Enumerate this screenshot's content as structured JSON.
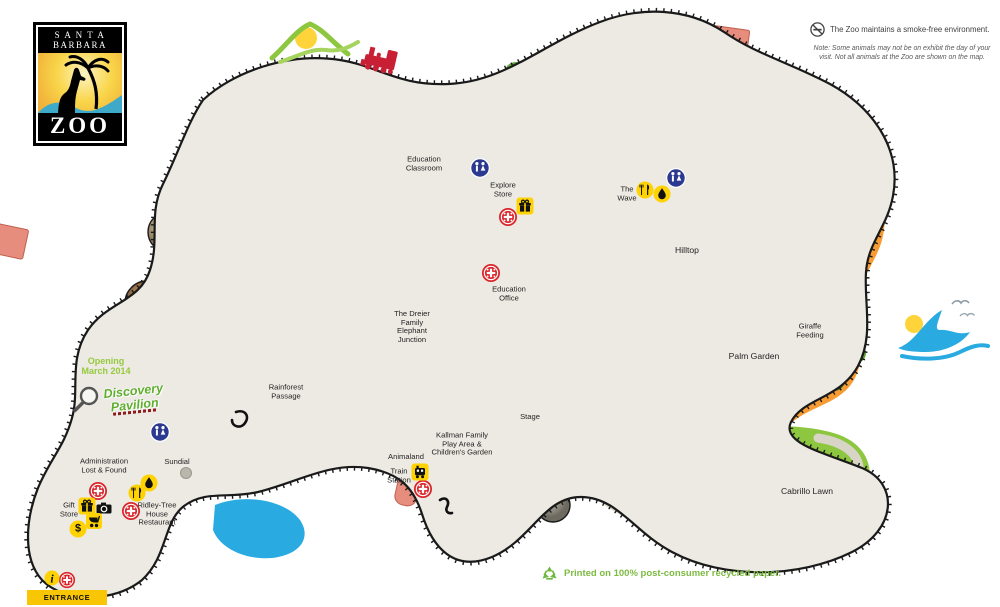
{
  "logo": {
    "city": "S A N T A\nBARBARA",
    "zoo": "ZOO"
  },
  "header_note": {
    "smoke_free": "The Zoo maintains a smoke-free environment.",
    "disclaimer": "Note: Some animals may not be on exhibit the day of your\nvisit.  Not all animals at the Zoo are shown on the map."
  },
  "footer": {
    "recycled": "Printed on 100% post-consumer recycled paper."
  },
  "locations": {
    "education_classroom": "Education\nClassroom",
    "explore_store": "Explore\nStore",
    "the_wave": "The\nWave",
    "hilltop": "Hilltop",
    "education_office": "Education\nOffice",
    "elephant_junction": "The Dreier\nFamily\nElephant\nJunction",
    "rainforest_passage": "Rainforest\nPassage",
    "giraffe_feeding": "Giraffe\nFeeding",
    "palm_garden": "Palm Garden",
    "stage": "Stage",
    "kallman": "Kallman Family\nPlay Area &\nChildren's Garden",
    "animaland": "Animaland",
    "train_station": "Train\nStation",
    "cabrillo_lawn": "Cabrillo Lawn",
    "administration": "Administration\nLost & Found",
    "sundial": "Sundial",
    "gift_store": "Gift\nStore",
    "ridley_tree": "Ridley-Tree\nHouse\nRestaurant",
    "entrance": "ENTRANCE",
    "opening": "Opening\nMarch 2014",
    "discovery_pavilion": "Discovery\nPavilion",
    "dollar_symbol": "$",
    "info_symbol": "i"
  },
  "icons": {
    "no_smoking": "no-smoking-icon",
    "restroom": "restroom-icon",
    "first_aid": "first-aid-icon",
    "gift": "gift-shop-icon",
    "food": "food-icon",
    "drink": "drink-icon",
    "camera": "camera-icon",
    "dollar": "dollar-icon",
    "stroller": "stroller-icon",
    "train": "train-station-icon",
    "info": "information-icon",
    "recycle": "recycle-icon",
    "magnifier": "magnifier-icon"
  },
  "colors": {
    "land": "#ECEAE3",
    "orange": "#F79C33",
    "green": "#8DC63F",
    "water": "#29ABE2",
    "path": "#D8D4C6",
    "building": "#E78D7D",
    "icon_yellow": "#FFD203",
    "icon_red": "#D9262C",
    "icon_blue": "#2B3990",
    "accent_green": "#6FB842",
    "rail": "#1A1A1A"
  }
}
